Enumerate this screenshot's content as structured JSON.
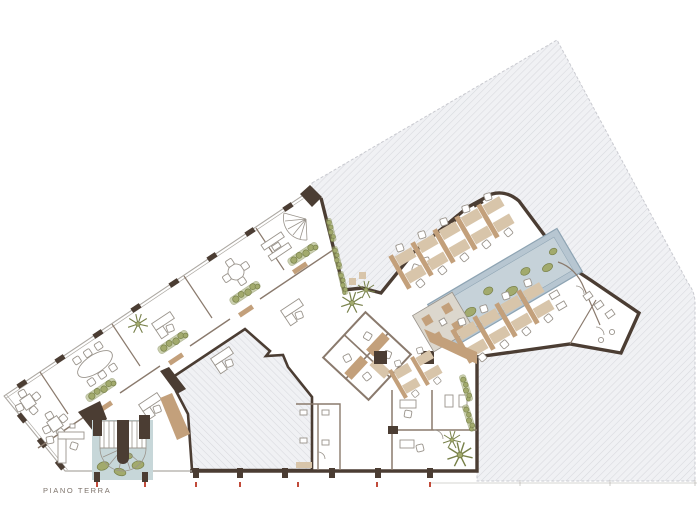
{
  "floor_plan": {
    "label": "PIANO TERRA"
  },
  "palette": {
    "wall": "#4b3d33",
    "thin-wall": "#8a7a6d",
    "glass": "#aeaaa4",
    "hatch-line": "#d8d9de",
    "hatch-bg": "#f0f1f4",
    "hatch-edge": "#c9cad0",
    "tan": "#c3a07b",
    "tan-light": "#d8c5aa",
    "plant": "#a2aa6d",
    "plant-dark": "#78814a",
    "pool-fill": "#b7c6d1",
    "pool-edge": "#8ea4b3",
    "pool-inner": "#c6d2d9",
    "lobby-floor": "#c7d7d9",
    "furn-line": "#9a948c",
    "label-color": "#7d736b",
    "accent-red": "#c24b3a"
  }
}
